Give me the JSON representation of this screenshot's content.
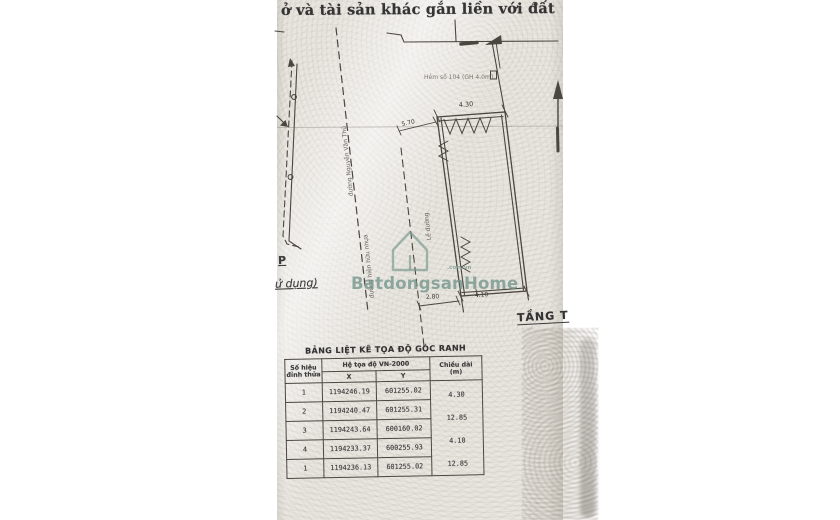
{
  "document": {
    "title_fragment": "ở và tài sản khác gắn liền với đất",
    "drawing": {
      "labels": {
        "alley": "Hẻm số 104 (GH 4.0m)",
        "road_name": "đường Nguyễn Văn Thủ",
        "road_existing": "đường hiện hữu nhựa",
        "curb": "Lề đường",
        "floor": "TẦNG T",
        "frag_p": "P",
        "frag_sd": "ử dụng)"
      },
      "dims": {
        "top": "4.30",
        "offset_left": "5.70",
        "offset_bottom": "2.80",
        "bottom": "4.10"
      }
    },
    "table": {
      "title": "BẢNG LIỆT KÊ TỌA ĐỘ GÓC RANH",
      "header": {
        "point_l1": "Số hiệu",
        "point_l2": "đỉnh thửa",
        "coords": "Hệ tọa độ VN-2000",
        "x": "X",
        "y": "Y",
        "len_l1": "Chiều dài",
        "len_l2": "(m)"
      },
      "rows": [
        {
          "id": "1",
          "x": "1194246.19",
          "y": "601255.02"
        },
        {
          "id": "2",
          "x": "1194240.47",
          "y": "601255.31"
        },
        {
          "id": "3",
          "x": "1194243.64",
          "y": "600160.02"
        },
        {
          "id": "4",
          "x": "1194233.37",
          "y": "600255.93"
        },
        {
          "id": "1",
          "x": "1194236.13",
          "y": "601255.02"
        }
      ],
      "lengths": [
        "4.30",
        "12.85",
        "4.10",
        "12.85"
      ]
    },
    "watermark": {
      "text": "BatdongsanHome",
      "suffix": ".com.vn",
      "color": "#74968c"
    }
  }
}
